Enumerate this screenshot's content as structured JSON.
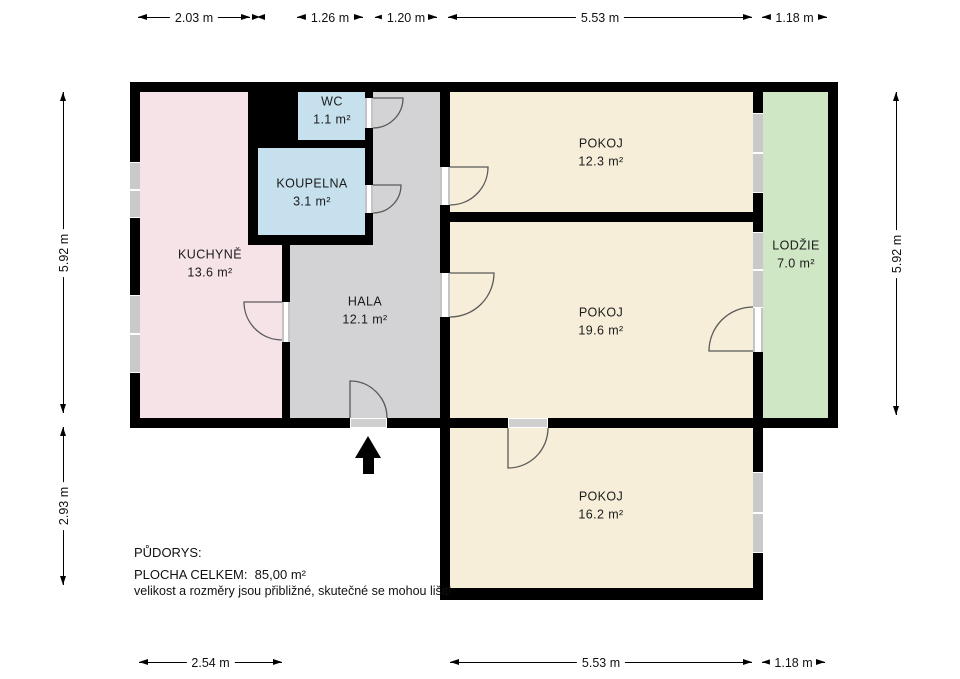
{
  "plan": {
    "rooms": [
      {
        "name": "KUCHYNĚ",
        "area": "13.6 m²",
        "color": "#f6e3e8"
      },
      {
        "name": "WC",
        "area": "1.1 m²",
        "color": "#c6e0ed"
      },
      {
        "name": "KOUPELNA",
        "area": "3.1 m²",
        "color": "#c6e0ed"
      },
      {
        "name": "HALA",
        "area": "12.1 m²",
        "color": "#d3d2d4"
      },
      {
        "name": "POKOJ",
        "area": "12.3 m²",
        "color": "#f6eed9"
      },
      {
        "name": "POKOJ",
        "area": "19.6 m²",
        "color": "#f6eed9"
      },
      {
        "name": "LODŽIE",
        "area": "7.0 m²",
        "color": "#cfe7c4"
      },
      {
        "name": "POKOJ",
        "area": "16.2 m²",
        "color": "#f6eed9"
      }
    ],
    "colors": {
      "wall": "#000000",
      "window": "#c9c9c9",
      "background": "#ffffff"
    }
  },
  "dimensions": {
    "top": [
      {
        "label": "2.03 m"
      },
      {
        "label": "1.26 m"
      },
      {
        "label": "1.20 m"
      },
      {
        "label": "5.53 m"
      },
      {
        "label": "1.18 m"
      }
    ],
    "left": [
      {
        "label": "5.92 m"
      },
      {
        "label": "2.93 m"
      }
    ],
    "right": [
      {
        "label": "5.92 m"
      }
    ],
    "bottom": [
      {
        "label": "2.54 m"
      },
      {
        "label": "5.53 m"
      },
      {
        "label": "1.18 m"
      }
    ]
  },
  "footer": {
    "title": "PŮDORYS:",
    "total_label": "PLOCHA CELKEM:",
    "total_value": "85,00 m²",
    "disclaimer": "velikost a rozměry jsou přibližné, skutečné se mohou lišit!"
  }
}
